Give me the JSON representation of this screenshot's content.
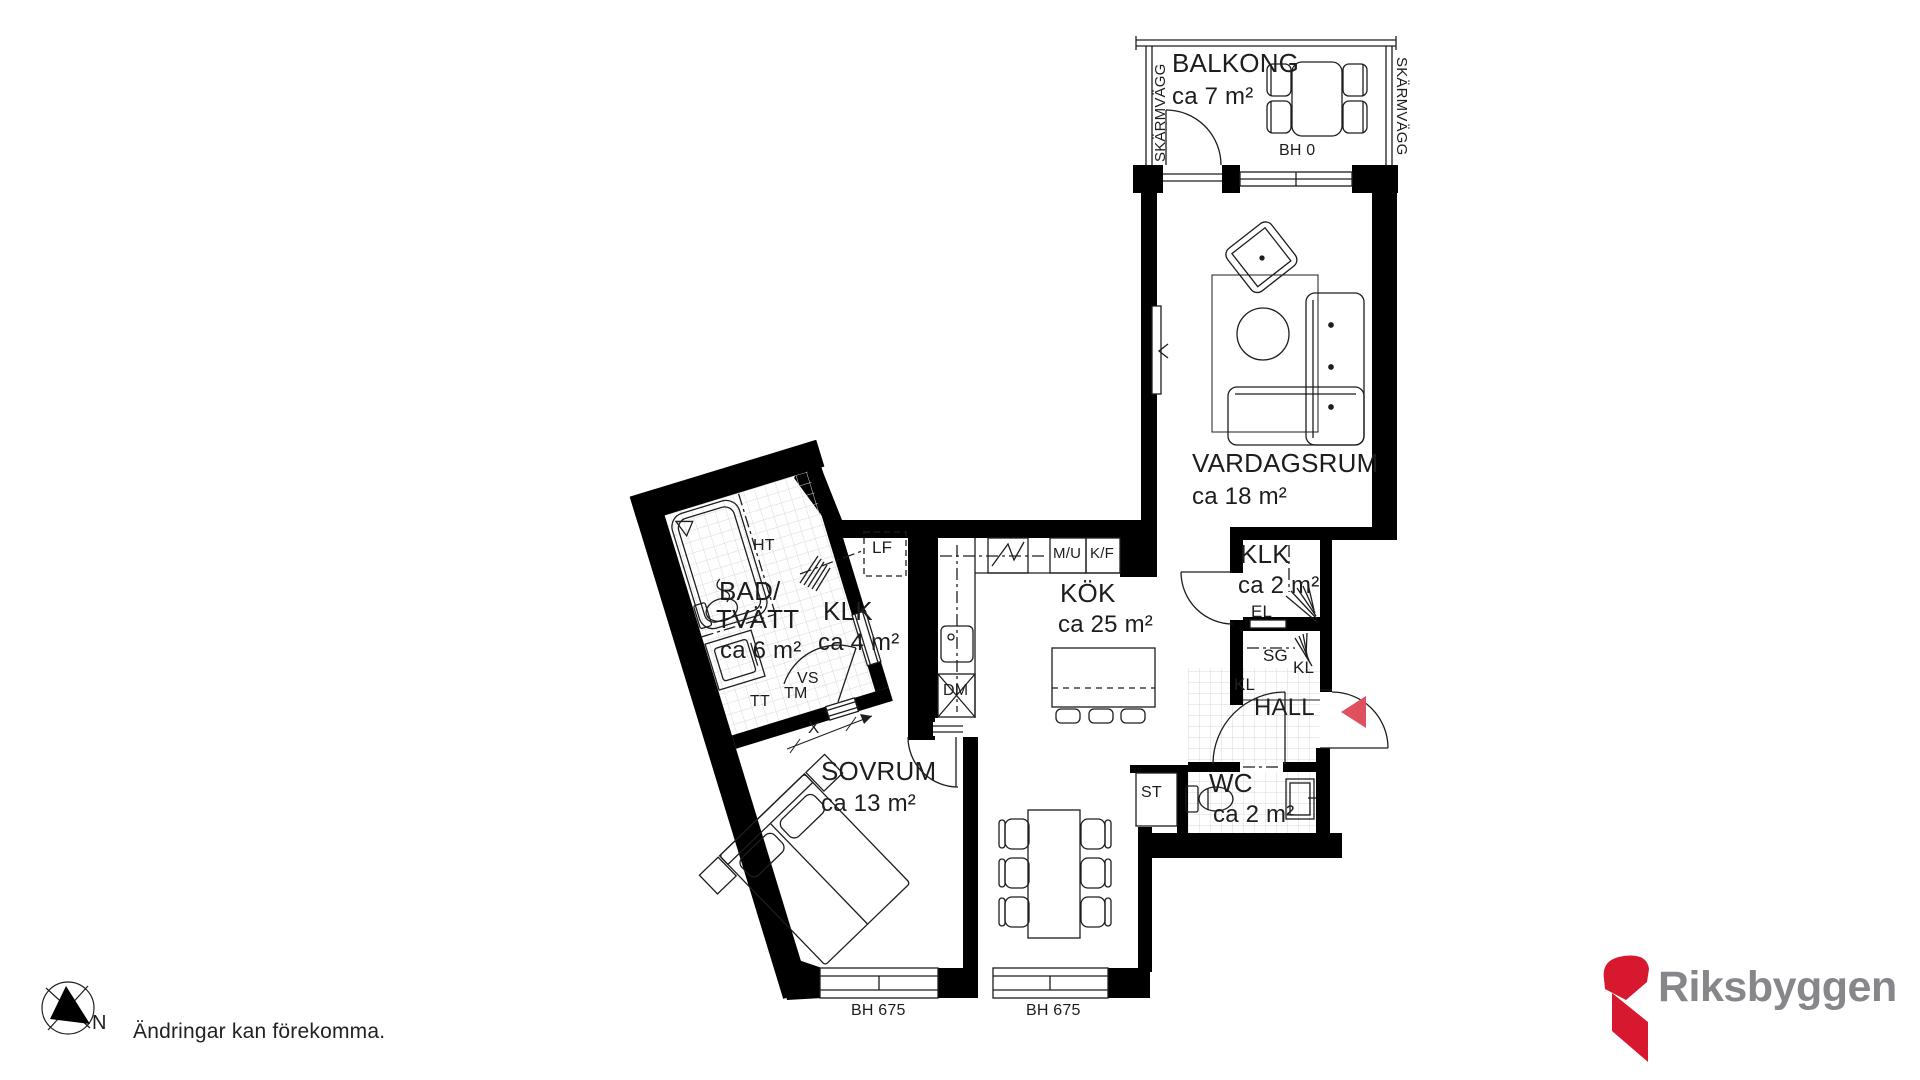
{
  "rooms": {
    "balcony": {
      "name": "BALKONG",
      "area": "ca 7 m²",
      "sill": "BH 0"
    },
    "living": {
      "name": "VARDAGSRUM",
      "area": "ca 18 m²"
    },
    "closet_small": {
      "name": "KLK",
      "area": "ca 2 m²"
    },
    "kitchen": {
      "name": "KÖK",
      "area": "ca 25 m²"
    },
    "hall": {
      "name": "HALL"
    },
    "wc": {
      "name": "WC",
      "area": "ca 2 m²"
    },
    "bath": {
      "name_line1": "BAD/",
      "name_line2": "TVÄTT",
      "area": "ca 6 m²"
    },
    "closet_walkin": {
      "name": "KLK",
      "area": "ca 4 m²"
    },
    "bedroom": {
      "name": "SOVRUM",
      "area": "ca 13 m²"
    }
  },
  "fixtures": {
    "screen_wall": "SKÄRMVÄGG",
    "electric": "EL",
    "sliding_doors": "SG",
    "wardrobe": "KL",
    "storage": "ST",
    "lf": "LF",
    "towel_dryer": "HT",
    "dryer": "TT",
    "washer": "TM",
    "vs": "VS",
    "dishwasher": "DM",
    "micro_oven": "M/U",
    "fridge_freezer": "K/F",
    "dimension": "X",
    "window_sill": "BH 675"
  },
  "compass": {
    "north": "N"
  },
  "footer": {
    "disclaimer": "Ändringar kan förekomma.",
    "brand": "Riksbyggen"
  },
  "colors": {
    "wall": "#000000",
    "line": "#1d1d1d",
    "tile": "#d8d8d8",
    "entry_arrow": "#e0515f",
    "logo_red": "#d7182f",
    "logo_gray": "#87878b"
  }
}
